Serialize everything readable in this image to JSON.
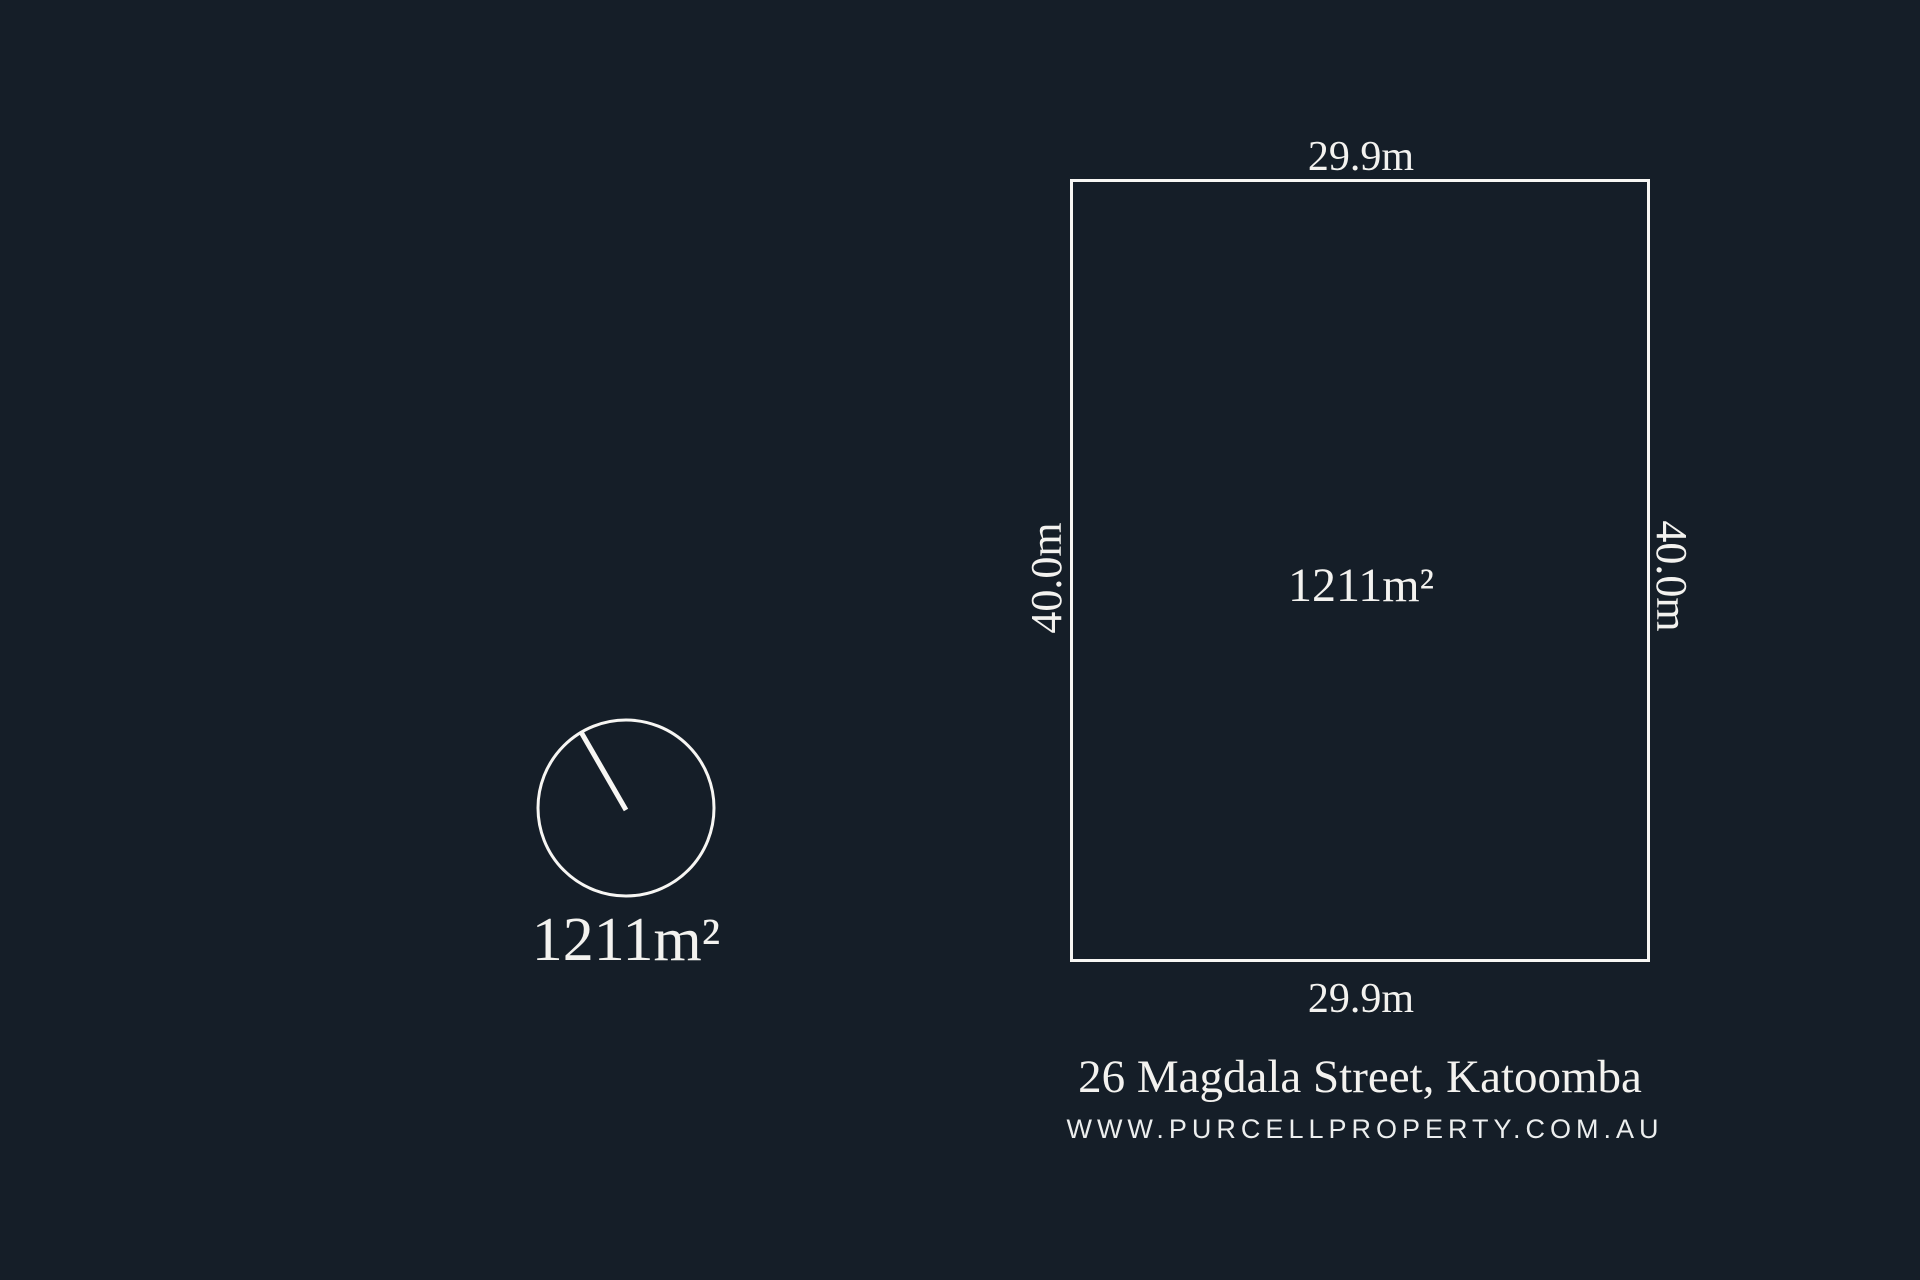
{
  "colors": {
    "background": "#151e28",
    "line": "#f7f6f3",
    "text": "#f3f2ef"
  },
  "lot": {
    "area": "1211m²",
    "top_dimension": "29.9m",
    "bottom_dimension": "29.9m",
    "left_dimension": "40.0m",
    "right_dimension": "40.0m"
  },
  "north_indicator": {
    "area": "1211m²"
  },
  "footer": {
    "address": "26 Magdala Street, Katoomba",
    "website": "WWW.PURCELLPROPERTY.COM.AU"
  }
}
